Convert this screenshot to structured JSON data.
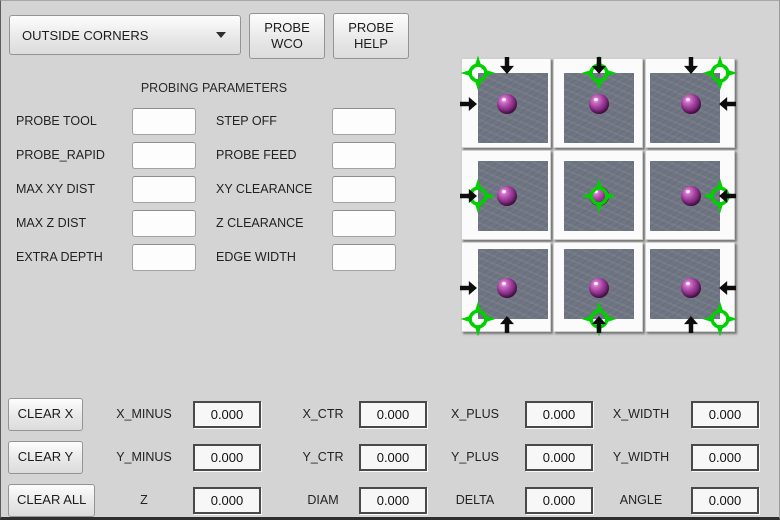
{
  "window": {
    "background": "#d4d4d4"
  },
  "toolbar": {
    "mode_select": {
      "value": "OUTSIDE CORNERS"
    },
    "probe_wco_label": "PROBE WCO",
    "probe_help_label": "PROBE HELP"
  },
  "parameters": {
    "title": "PROBING PARAMETERS",
    "rows": [
      {
        "left_label": "PROBE TOOL",
        "left_value": "",
        "right_label": "STEP OFF",
        "right_value": ""
      },
      {
        "left_label": "PROBE_RAPID",
        "left_value": "",
        "right_label": "PROBE FEED",
        "right_value": ""
      },
      {
        "left_label": "MAX XY DIST",
        "left_value": "",
        "right_label": "XY CLEARANCE",
        "right_value": ""
      },
      {
        "left_label": "MAX Z DIST",
        "left_value": "",
        "right_label": "Z CLEARANCE",
        "right_value": ""
      },
      {
        "left_label": "EXTRA DEPTH",
        "left_value": "",
        "right_label": "EDGE WIDTH",
        "right_value": ""
      }
    ]
  },
  "probe_grid": {
    "colors": {
      "target_green": "#00cf00",
      "workpiece_gray": "#6f7582",
      "probe_ball_purple": "#9b3a97"
    },
    "cells": [
      {
        "id": "top-left-corner",
        "approach": [
          "down",
          "right"
        ]
      },
      {
        "id": "top-edge",
        "approach": [
          "down"
        ]
      },
      {
        "id": "top-right-corner",
        "approach": [
          "down",
          "left"
        ]
      },
      {
        "id": "left-edge",
        "approach": [
          "right"
        ]
      },
      {
        "id": "center",
        "approach": []
      },
      {
        "id": "right-edge",
        "approach": [
          "left"
        ]
      },
      {
        "id": "bottom-left-corner",
        "approach": [
          "up",
          "right"
        ]
      },
      {
        "id": "bottom-edge",
        "approach": [
          "up"
        ]
      },
      {
        "id": "bottom-right-corner",
        "approach": [
          "up",
          "left"
        ]
      }
    ]
  },
  "results": {
    "rows": [
      {
        "button": "CLEAR X",
        "fields": [
          {
            "label": "X_MINUS",
            "value": "0.000"
          },
          {
            "label": "X_CTR",
            "value": "0.000"
          },
          {
            "label": "X_PLUS",
            "value": "0.000"
          },
          {
            "label": "X_WIDTH",
            "value": "0.000"
          }
        ]
      },
      {
        "button": "CLEAR Y",
        "fields": [
          {
            "label": "Y_MINUS",
            "value": "0.000"
          },
          {
            "label": "Y_CTR",
            "value": "0.000"
          },
          {
            "label": "Y_PLUS",
            "value": "0.000"
          },
          {
            "label": "Y_WIDTH",
            "value": "0.000"
          }
        ]
      },
      {
        "button": "CLEAR ALL",
        "fields": [
          {
            "label": "Z",
            "value": "0.000"
          },
          {
            "label": "DIAM",
            "value": "0.000"
          },
          {
            "label": "DELTA",
            "value": "0.000"
          },
          {
            "label": "ANGLE",
            "value": "0.000"
          }
        ]
      }
    ]
  }
}
